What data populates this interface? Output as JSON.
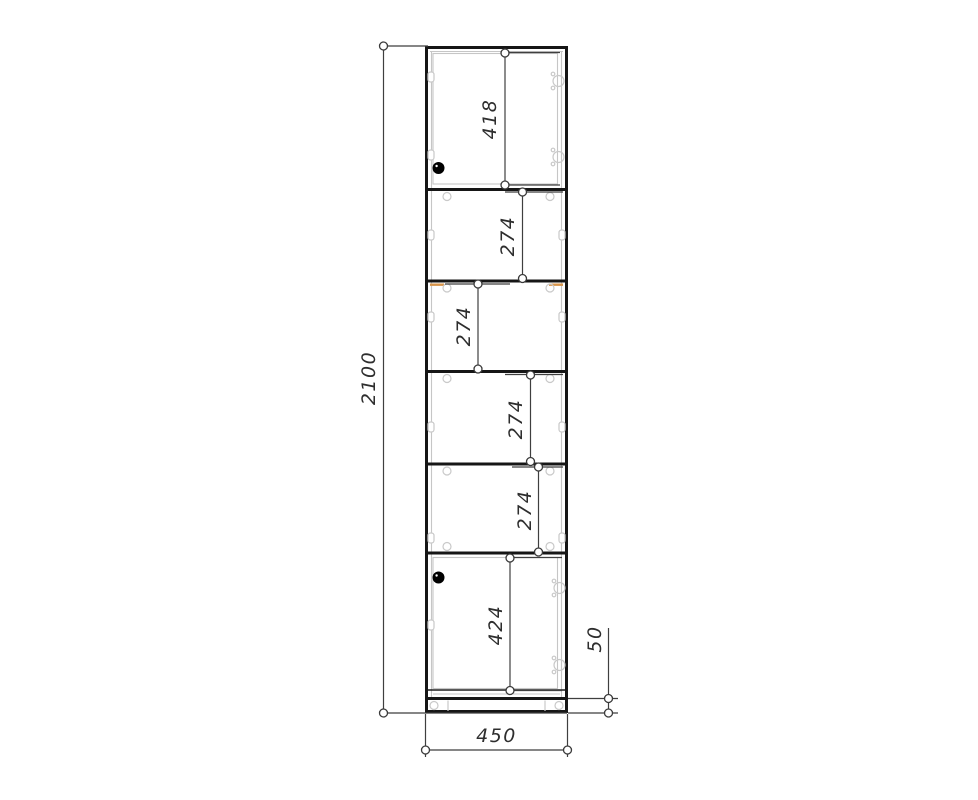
{
  "drawing": {
    "type": "furniture-dimension-drawing",
    "subject": "tall cabinet front elevation with shelf spacing dimensions",
    "units": "mm",
    "dimensions": {
      "overall_height": {
        "label": "2100"
      },
      "overall_width": {
        "label": "450"
      },
      "top_door": {
        "label": "418"
      },
      "section_2": {
        "label": "274"
      },
      "section_3": {
        "label": "274"
      },
      "section_4": {
        "label": "274"
      },
      "section_5": {
        "label": "274"
      },
      "bottom_door": {
        "label": "424"
      },
      "plinth": {
        "label": "50"
      }
    },
    "colors": {
      "outline": "#161616",
      "dimension_line": "#3f3f3f",
      "panel_gray": "#c6c6c6",
      "shelf_edge_orange": "#d8954a",
      "knob": "#000000",
      "background": "#ffffff"
    }
  }
}
